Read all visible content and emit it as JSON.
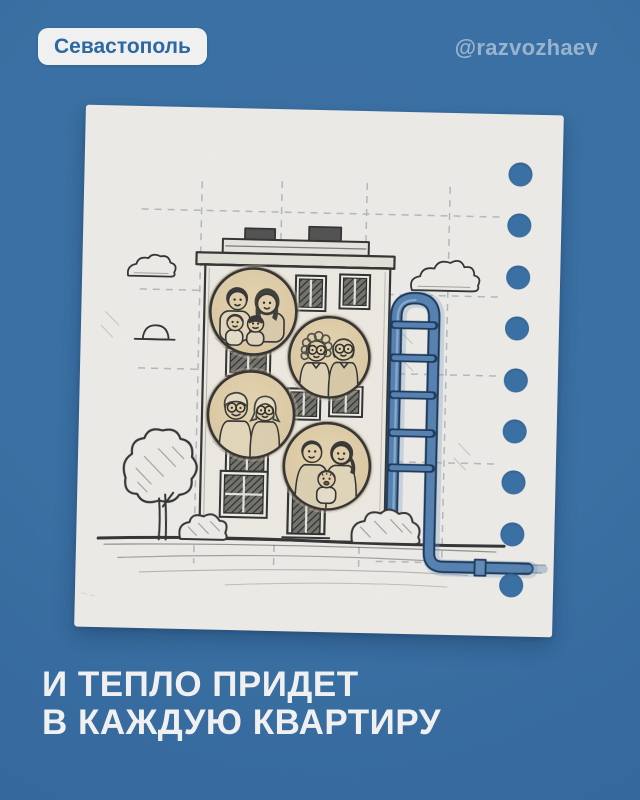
{
  "page": {
    "background_color": "#3e77ae"
  },
  "header": {
    "badge": {
      "label": "Севастополь",
      "background": "#ffffff",
      "text_color": "#2f6fad"
    },
    "handle": {
      "text": "@razvozhaev",
      "color": "#a9c6e0"
    }
  },
  "note_card": {
    "paper_color": "#f9f8f4",
    "punch_holes": 9,
    "hole_color": "#3e77ae",
    "illustration": {
      "scene": "hand-drawn apartment building with four circular family portraits, blue heating pipe, tree, bushes and clouds on a dashed blueprint grid",
      "portraits": [
        "family-with-two-children",
        "elderly-couple-with-glasses",
        "couple-with-glasses",
        "parents-with-child"
      ],
      "pipe_color": "#5c8abb",
      "portrait_fill": "#e9d6ae",
      "sketch_color": "#3d3d3d"
    }
  },
  "caption": {
    "line1": "И ТЕПЛО ПРИДЕТ",
    "line2": "В КАЖДУЮ КВАРТИРУ",
    "color": "#ffffff"
  }
}
